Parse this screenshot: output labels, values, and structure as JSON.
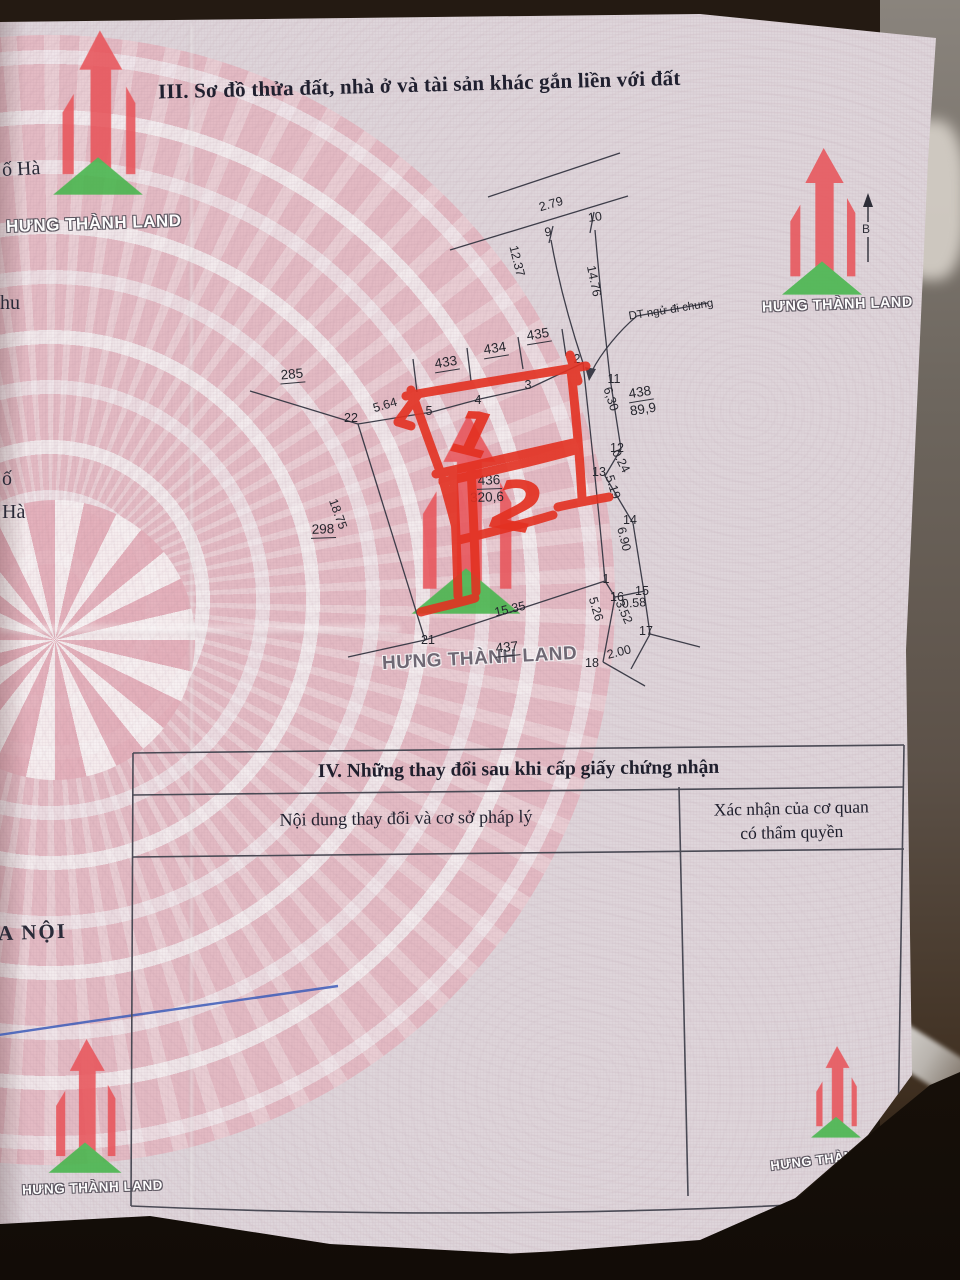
{
  "document": {
    "section3_title": "III. Sơ đồ thửa đất, nhà ở và tài sản khác gắn liền với đất",
    "section4_title": "IV. Những thay đổi sau khi cấp giấy chứng nhận",
    "table": {
      "col1_header": "Nội dung thay đổi và cơ sở pháp lý",
      "col2_header_line1": "Xác nhận của cơ quan",
      "col2_header_line2": "có thẩm quyền"
    },
    "edge_texts": {
      "t1": "ố Hà",
      "t2": "hu",
      "t3": "ố",
      "t4": "Hà",
      "t5": "A NỘI"
    }
  },
  "brand": {
    "name": "HƯNG THÀNH LAND",
    "red": "#e8555b",
    "green": "#46b54c"
  },
  "compass": {
    "north_label": "B"
  },
  "annotations": {
    "red_top": "1",
    "red_bottom": "2",
    "pen_color": "#e33122",
    "blue_pen_color": "#3c5cb8"
  },
  "diagram": {
    "note": "DT ngử đi chung",
    "labels": [
      {
        "id": "pt-9",
        "t": "9",
        "x": 548,
        "y": 232,
        "r": -8,
        "c": "pt"
      },
      {
        "id": "pt-10",
        "t": "10",
        "x": 595,
        "y": 217,
        "r": -8,
        "c": "pt"
      },
      {
        "id": "pt-2",
        "t": "2",
        "x": 577,
        "y": 359,
        "r": 0,
        "c": "pt"
      },
      {
        "id": "pt-11",
        "t": "11",
        "x": 614,
        "y": 379,
        "r": 0,
        "c": "pt"
      },
      {
        "id": "pt-3",
        "t": "3",
        "x": 528,
        "y": 385,
        "r": 0,
        "c": "pt"
      },
      {
        "id": "pt-4",
        "t": "4",
        "x": 478,
        "y": 400,
        "r": 0,
        "c": "pt"
      },
      {
        "id": "pt-5",
        "t": "5",
        "x": 429,
        "y": 411,
        "r": 0,
        "c": "pt"
      },
      {
        "id": "pt-22",
        "t": "22",
        "x": 351,
        "y": 418,
        "r": 0,
        "c": "pt"
      },
      {
        "id": "pt-12",
        "t": "12",
        "x": 617,
        "y": 448,
        "r": 0,
        "c": "pt"
      },
      {
        "id": "pt-13",
        "t": "13",
        "x": 599,
        "y": 472,
        "r": 0,
        "c": "pt"
      },
      {
        "id": "pt-14",
        "t": "14",
        "x": 630,
        "y": 520,
        "r": 0,
        "c": "pt"
      },
      {
        "id": "pt-1",
        "t": "1",
        "x": 606,
        "y": 579,
        "r": 0,
        "c": "pt"
      },
      {
        "id": "pt-16",
        "t": "16",
        "x": 617,
        "y": 597,
        "r": 0,
        "c": "pt"
      },
      {
        "id": "pt-15",
        "t": "15",
        "x": 642,
        "y": 591,
        "r": 0,
        "c": "pt"
      },
      {
        "id": "pt-17",
        "t": "17",
        "x": 646,
        "y": 631,
        "r": 0,
        "c": "pt"
      },
      {
        "id": "pt-18",
        "t": "18",
        "x": 592,
        "y": 663,
        "r": 0,
        "c": "pt"
      },
      {
        "id": "pt-21",
        "t": "21",
        "x": 428,
        "y": 640,
        "r": 0,
        "c": "pt"
      },
      {
        "id": "ms-279",
        "t": "2.79",
        "x": 551,
        "y": 204,
        "r": -16,
        "c": "ms"
      },
      {
        "id": "ms-1237",
        "t": "12.37",
        "x": 517,
        "y": 261,
        "r": 76,
        "c": "ms"
      },
      {
        "id": "ms-1476",
        "t": "14.76",
        "x": 594,
        "y": 281,
        "r": 78,
        "c": "ms"
      },
      {
        "id": "ms-564",
        "t": "5.64",
        "x": 385,
        "y": 405,
        "r": -16,
        "c": "ms"
      },
      {
        "id": "ms-1875",
        "t": "18.75",
        "x": 338,
        "y": 514,
        "r": 70,
        "c": "ms"
      },
      {
        "id": "ms-1535",
        "t": "15.35",
        "x": 510,
        "y": 609,
        "r": -13,
        "c": "ms"
      },
      {
        "id": "ms-630",
        "t": "6,30",
        "x": 611,
        "y": 399,
        "r": 72,
        "c": "ms"
      },
      {
        "id": "ms-024",
        "t": "0.24",
        "x": 621,
        "y": 461,
        "r": 62,
        "c": "ms"
      },
      {
        "id": "ms-519",
        "t": "5.19",
        "x": 613,
        "y": 487,
        "r": 72,
        "c": "ms"
      },
      {
        "id": "ms-690",
        "t": "6.90",
        "x": 624,
        "y": 539,
        "r": 76,
        "c": "ms"
      },
      {
        "id": "ms-058",
        "t": "0.58",
        "x": 634,
        "y": 603,
        "r": -4,
        "c": "ms"
      },
      {
        "id": "ms-526",
        "t": "5.26",
        "x": 596,
        "y": 609,
        "r": 74,
        "c": "ms"
      },
      {
        "id": "ms-352",
        "t": "3.52",
        "x": 624,
        "y": 612,
        "r": 66,
        "c": "ms"
      },
      {
        "id": "ms-200",
        "t": "2.00",
        "x": 619,
        "y": 652,
        "r": -14,
        "c": "ms"
      },
      {
        "id": "plot-433",
        "t": "433",
        "x": 446,
        "y": 363,
        "r": -9,
        "c": "pl"
      },
      {
        "id": "plot-434",
        "t": "434",
        "x": 495,
        "y": 349,
        "r": -9,
        "c": "pl"
      },
      {
        "id": "plot-435",
        "t": "435",
        "x": 538,
        "y": 335,
        "r": -9,
        "c": "pl"
      },
      {
        "id": "plot-285",
        "t": "285",
        "x": 292,
        "y": 375,
        "r": -5,
        "c": "pl"
      },
      {
        "id": "plot-438",
        "t": "438",
        "x": 640,
        "y": 393,
        "r": -9,
        "c": "pl"
      },
      {
        "id": "area-438",
        "t": "89,9",
        "x": 643,
        "y": 409,
        "r": -9,
        "c": "ar"
      },
      {
        "id": "plot-436",
        "t": "436",
        "x": 489,
        "y": 481,
        "r": -2,
        "c": "pl"
      },
      {
        "id": "area-436",
        "t": "320,6",
        "x": 487,
        "y": 497,
        "r": -2,
        "c": "ar"
      },
      {
        "id": "plot-298",
        "t": "298",
        "x": 323,
        "y": 530,
        "r": -2,
        "c": "pl"
      },
      {
        "id": "plot-437",
        "t": "437",
        "x": 507,
        "y": 648,
        "r": -6,
        "c": "pl"
      }
    ]
  }
}
